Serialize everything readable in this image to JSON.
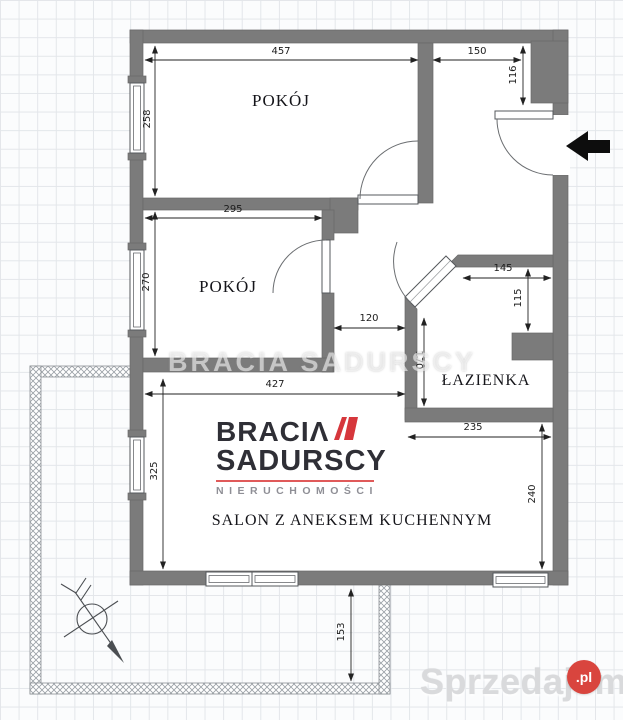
{
  "plan": {
    "rooms": [
      {
        "id": "room1",
        "label": "POKÓJ"
      },
      {
        "id": "room2",
        "label": "POKÓJ"
      },
      {
        "id": "bathroom",
        "label": "ŁAZIENKA"
      },
      {
        "id": "salon",
        "label": "SALON Z ANEKSEM KUCHENNYM"
      }
    ],
    "dims": {
      "room1_width": "457",
      "room1_depth": "258",
      "hall_width": "150",
      "entry_depth": "116",
      "room2_width": "295",
      "room2_depth": "270",
      "corridor_width": "120",
      "bath_width": "145",
      "bath_depth_right": "115",
      "bath_depth_left": "170",
      "salon_width": "427",
      "kitchen_width": "235",
      "kitchen_depth": "240",
      "salon_depth": "325",
      "balcony_depth": "153"
    }
  },
  "watermark": {
    "text": "BRACIA SADURSCY"
  },
  "agency_logo": {
    "line1": "BRACIΛ",
    "line2": "SADURSCY",
    "tagline": "NIERUCHOMOŚCI"
  },
  "portal_logo": {
    "text": "Sprzedajemy",
    "badge": ".pl"
  },
  "icons": {
    "entrance_arrow": "left-arrow",
    "compass": "north-arrow"
  },
  "colors": {
    "wall": "#7b7b7b",
    "accent_red": "#d6373c",
    "badge_red": "#d9453e",
    "dim_line": "#222222"
  }
}
